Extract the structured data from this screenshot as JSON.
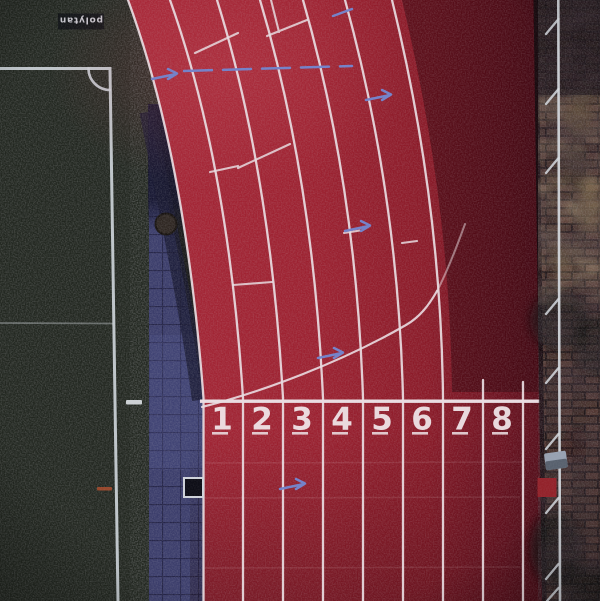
{
  "scene": {
    "description": "Aerial drone photo of an eight-lane red running track beside a dark soccer field, with a tiled walkway and a brick-paved strip",
    "lane_count": 8
  },
  "branding": {
    "logo_text": "polytan"
  },
  "track": {
    "lane_numbers": [
      "1",
      "2",
      "3",
      "4",
      "5",
      "6",
      "7",
      "8"
    ]
  },
  "palette": {
    "track_red": "#9c2130",
    "track_line_white": "#eadde2",
    "number_white": "#f2e8eb",
    "arrow_blue": "#7381c9",
    "field_green": "#222720",
    "field_line_white": "#ccd2d8",
    "tile_navy": "#3b3d6b",
    "brick_brown": "#46302a",
    "edge_line_white": "#d6dae0",
    "red_patch": "#93222a",
    "orange_mark": "#a34a2c"
  }
}
